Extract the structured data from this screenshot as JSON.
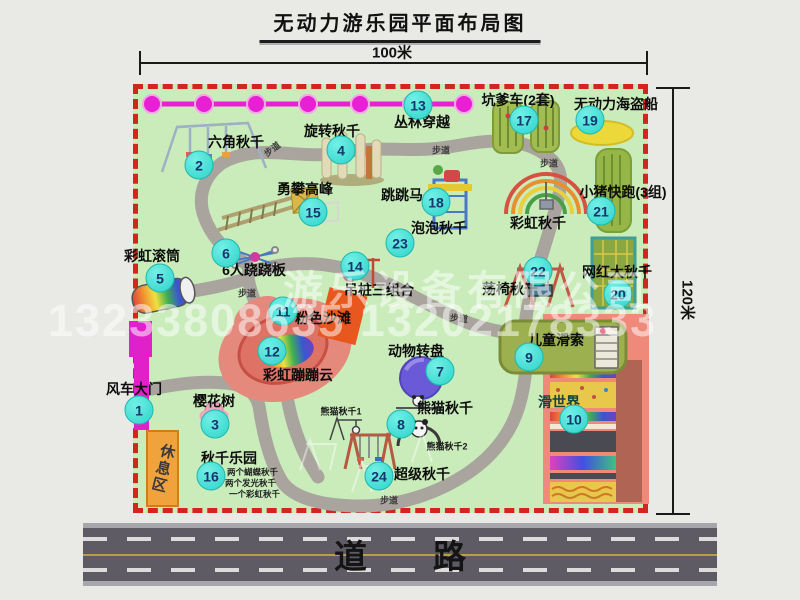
{
  "title": "无动力游乐园平面布局图",
  "dimensions": {
    "width": "100米",
    "height": "120米"
  },
  "attractions": [
    {
      "num": "1",
      "name": "风车大门"
    },
    {
      "num": "2",
      "name": "六角秋千"
    },
    {
      "num": "3",
      "name": "樱花树"
    },
    {
      "num": "4",
      "name": "旋转秋千"
    },
    {
      "num": "5",
      "name": "彩虹滚筒"
    },
    {
      "num": "6",
      "name": "6人跷跷板"
    },
    {
      "num": "7",
      "name": "动物转盘"
    },
    {
      "num": "8",
      "name": "熊猫秋千"
    },
    {
      "num": "9",
      "name": "儿童滑索"
    },
    {
      "num": "10",
      "name": "滑世界"
    },
    {
      "num": "11",
      "name": "粉色沙滩"
    },
    {
      "num": "12",
      "name": "彩虹蹦蹦云"
    },
    {
      "num": "13",
      "name": "丛林穿越"
    },
    {
      "num": "14",
      "name": "吊桩三组合"
    },
    {
      "num": "15",
      "name": "勇攀高峰"
    },
    {
      "num": "16",
      "name": "秋千乐园"
    },
    {
      "num": "17",
      "name": "坑爹车(2套)"
    },
    {
      "num": "18",
      "name": "跳跳马"
    },
    {
      "num": "19",
      "name": "无动力海盗船"
    },
    {
      "num": "20",
      "name": "网红大秋千"
    },
    {
      "num": "21",
      "name": "小猪快跑(3组)"
    },
    {
      "num": "22",
      "name": "荡椅秋千"
    },
    {
      "num": "23",
      "name": "泡泡秋千"
    },
    {
      "num": "24",
      "name": "超级秋千"
    }
  ],
  "extra_labels": {
    "rainbow_swing": "彩虹秋千",
    "rest_area": "休息区",
    "panda_swing_1": "熊猫秋千1",
    "panda_swing_2": "熊猫秋千2",
    "road": "道　　路"
  },
  "swing_park_notes": [
    "两个蝴蝶秋千",
    "两个发光秋千",
    "一个彩虹秋千"
  ],
  "path_label": "步道",
  "watermark": {
    "line1": "游乐设备有限公司",
    "line2": "13233808635 13202178333"
  },
  "colors": {
    "map_green": "#c9ecba",
    "border_red": "#d42420",
    "badge_teal": "#2ed3ca",
    "chain_magenta": "#e81fd2",
    "gate_magenta": "#e020c8",
    "rest_orange": "#f0a23c",
    "road_gray": "#5e5b65"
  }
}
